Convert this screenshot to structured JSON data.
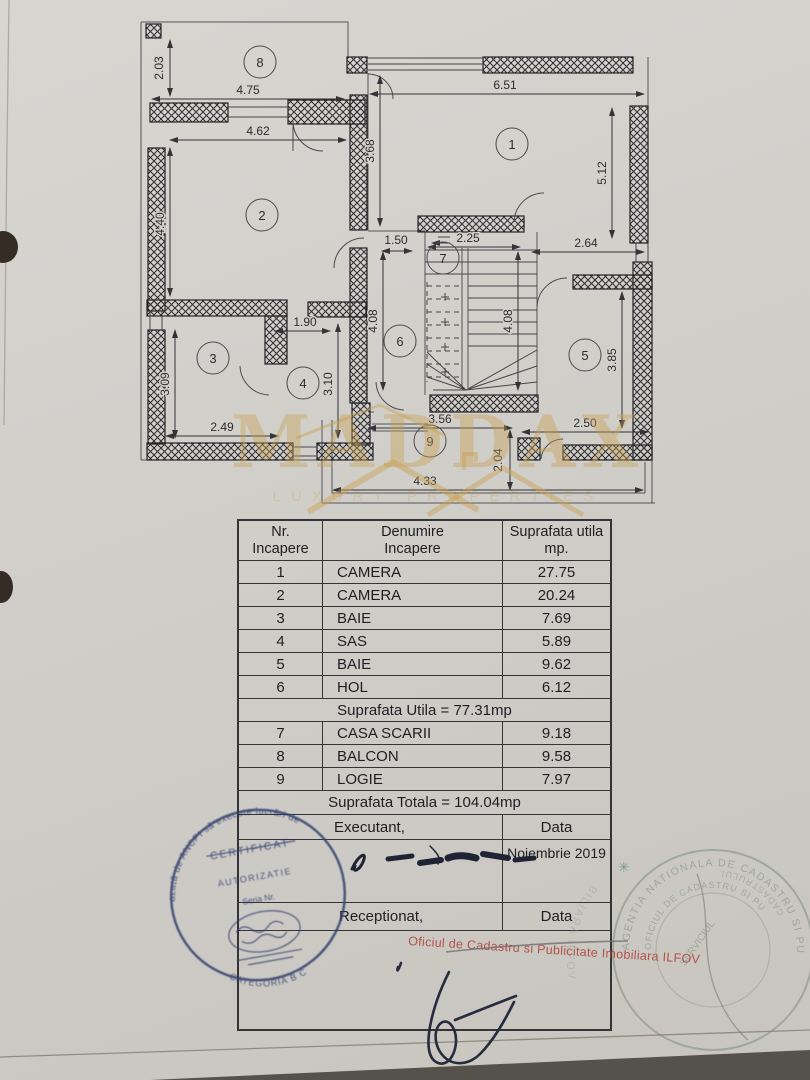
{
  "floor_plan": {
    "rooms": [
      "1",
      "2",
      "3",
      "4",
      "5",
      "6",
      "7",
      "8",
      "9"
    ],
    "dims": {
      "balcony_h": "2.03",
      "balcony_w": "4.75",
      "room2_w": "4.62",
      "room2_h": "4.40",
      "room1_w": "6.51",
      "hall_top_h": "3.68",
      "room1_h": "5.12",
      "hall_d": "1.50",
      "stairs_w": "2.25",
      "right_d": "2.64",
      "pass_w": "1.90",
      "room3_h": "3.09",
      "room4_h": "3.10",
      "stairs_h_left": "4.08",
      "stairs_h_right": "4.08",
      "room3_w": "2.49",
      "logie_top": "3.56",
      "room5_w": "2.50",
      "room5_h": "3.85",
      "logie_h": "2.04",
      "logie_w": "4.33"
    }
  },
  "watermark": {
    "brand": "MADDAX",
    "tagline": "LUXURY PROPERTIES",
    "color": "#c9a050"
  },
  "table": {
    "header": {
      "c1a": "Nr.",
      "c1b": "Incapere",
      "c2a": "Denumire",
      "c2b": "Incapere",
      "c3a": "Suprafata utila",
      "c3b": "mp."
    },
    "rows": [
      {
        "nr": "1",
        "den": "CAMERA",
        "sup": "27.75"
      },
      {
        "nr": "2",
        "den": "CAMERA",
        "sup": "20.24"
      },
      {
        "nr": "3",
        "den": "BAIE",
        "sup": "7.69"
      },
      {
        "nr": "4",
        "den": "SAS",
        "sup": "5.89"
      },
      {
        "nr": "5",
        "den": "BAIE",
        "sup": "9.62"
      },
      {
        "nr": "6",
        "den": "HOL",
        "sup": "6.12"
      }
    ],
    "subtotal": "Suprafata Utila = 77.31mp",
    "rows2": [
      {
        "nr": "7",
        "den": "CASA SCARII",
        "sup": "9.18"
      },
      {
        "nr": "8",
        "den": "BALCON",
        "sup": "9.58"
      },
      {
        "nr": "9",
        "den": "LOGIE",
        "sup": "7.97"
      }
    ],
    "total": "Suprafata Totala = 104.04mp",
    "executant": "Executant,",
    "data1": "Data",
    "date": "Noiembrie 2019",
    "receptionat": "Receptionat,",
    "data2": "Data"
  },
  "stamps": {
    "red_line": "Oficiul de Cadastru si Publicitate Imobiliara ILFOV",
    "red_color": "#b04038",
    "blue": {
      "arc_top": "azată de ANCPI să execute lucrări de",
      "line1": "CERTIFICAT",
      "line2": "AUTORIZATIE",
      "line3": "Seria Nr.",
      "arc_bottom": "CATEGORIA B C"
    },
    "green": {
      "arc_outer": "AGENTIA NATIONALA DE CADASTRU SI PUBLI",
      "arc_inner": "OFICIUL DE CADASTRU SI PU",
      "diag": "SERVICIUL",
      "arc_bottom": "CADASTRULUI",
      "star": "✳",
      "ghost_arc": "BILIARA ILFOV"
    }
  }
}
